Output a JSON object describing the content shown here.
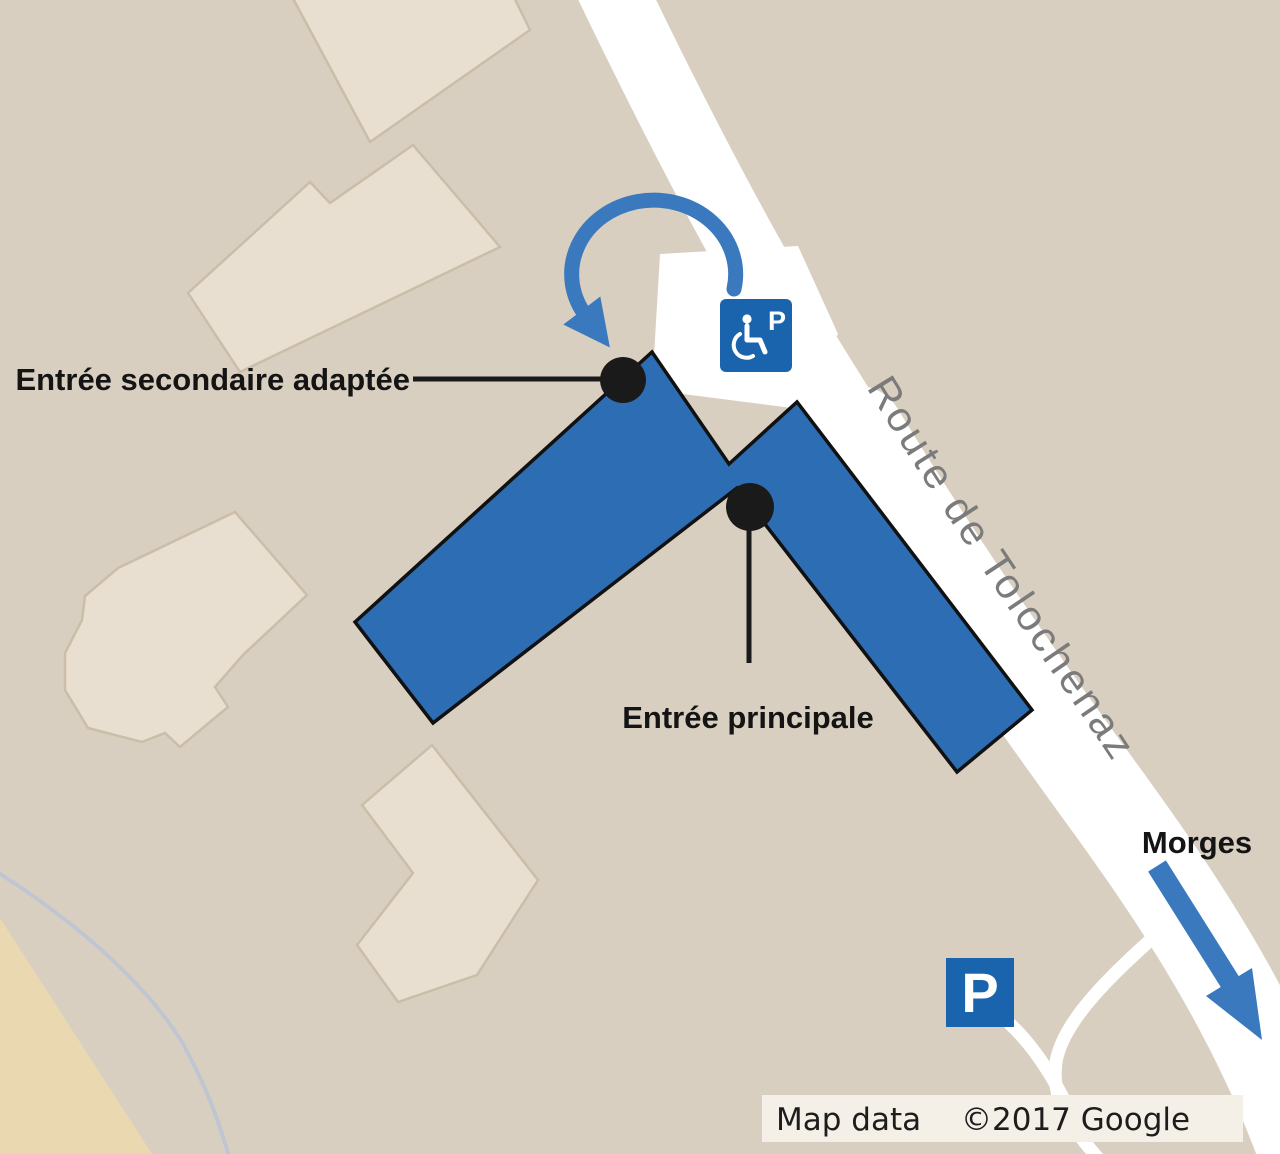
{
  "map": {
    "road_label": "Route de Tolochenaz",
    "destination_label": "Morges",
    "annotations": {
      "secondary_entrance_label": "Entrée secondaire adaptée",
      "main_entrance_label": "Entrée principale"
    },
    "signs": {
      "accessible_parking_letter": "P",
      "parking_letter": "P",
      "accessible_icon": "wheelchair-icon"
    },
    "attribution": {
      "left": "Map data",
      "right": "©2017 Google"
    },
    "colors": {
      "background": "#d9cfc1",
      "building_fill": "#e8dfd0",
      "building_border": "#cbbda7",
      "road": "#ffffff",
      "highlight_building": "#2d6db4",
      "arrow_blue": "#3a79bd",
      "sign_blue": "#1a64ad",
      "sand": "#ead8b0",
      "road_text": "#7b7b7b",
      "annotation_black": "#1a1a1a",
      "attribution_bg": "#f4f0e8"
    }
  }
}
